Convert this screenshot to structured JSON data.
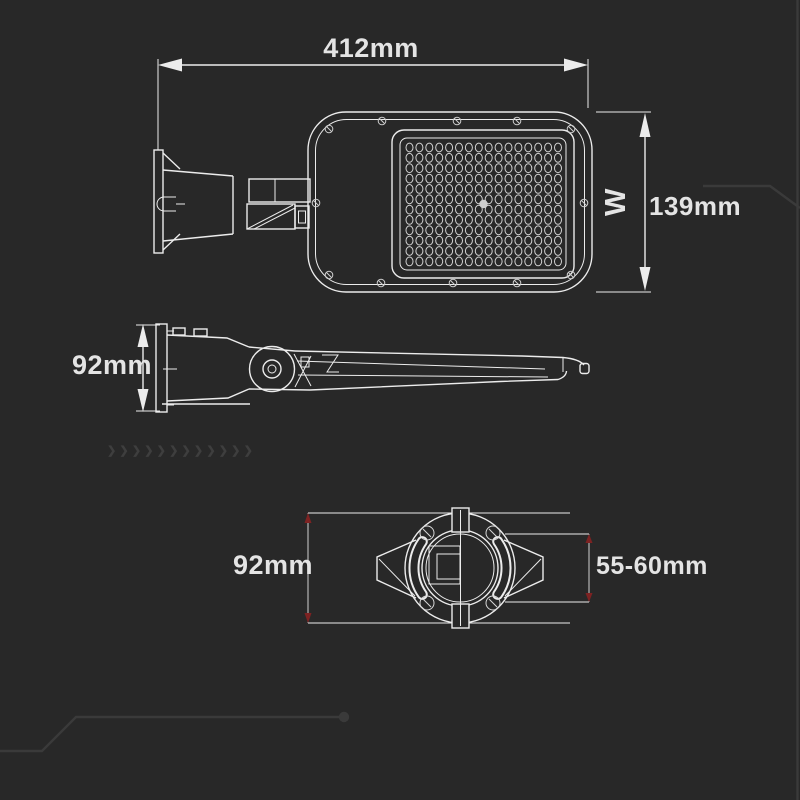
{
  "title": "LED street light dimensional drawing",
  "colors": {
    "background": "#282828",
    "line": "#ececec",
    "text": "#e4e4e4",
    "accent_red": "#7d2222",
    "trace": "#3a3a3a"
  },
  "views": {
    "top": {
      "width_label": "412mm",
      "height_label": "139mm",
      "axis_label": "W",
      "led_grid": {
        "cols": 16,
        "rows": 12
      }
    },
    "side": {
      "height_label": "92mm"
    },
    "bottom": {
      "clamp_diameter_label": "92mm",
      "pole_diameter_label": "55-60mm"
    }
  },
  "decor": {
    "chevrons": "❯❯❯❯❯❯❯❯❯❯❯❯"
  }
}
